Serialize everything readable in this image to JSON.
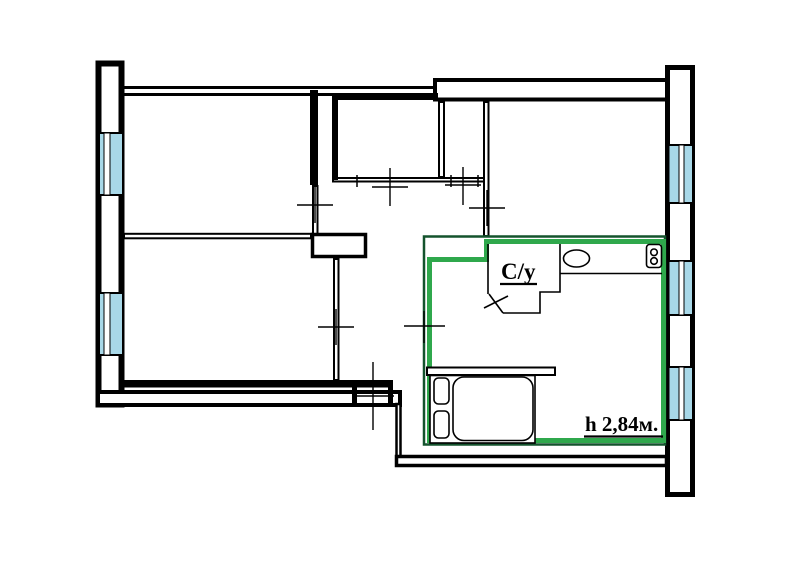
{
  "labels": {
    "bathroom": "С/у",
    "ceiling_height": "h 2,84м."
  },
  "colors": {
    "wall": "#000000",
    "window_glass": "#a8d8e8",
    "highlight": "#2fa84c",
    "highlight_dark": "#14532d",
    "background": "#ffffff"
  }
}
